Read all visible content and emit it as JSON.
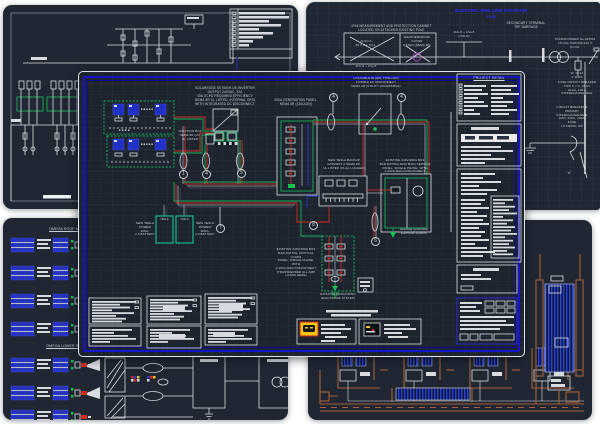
{
  "colors": {
    "sheet_bg": "#202733",
    "line": "#d9dde2",
    "blue_border": "#1414cd",
    "green": "#14b35a",
    "red": "#d22c20",
    "module_blue": "#2231c5",
    "brown": "#a85f38",
    "yellow": "#f3c512",
    "magenta": "#b545c8",
    "title_blue": "#2a2aff",
    "teal": "#12b98e"
  },
  "sheet_top_right": {
    "title": "ELECTRIC ONE LINE DIAGRAM",
    "scale": "1:100",
    "cabinet_note": "IP44 MEASUREMENT AND PROTECTION CABINET\nLOCATED ON ATTACHED EXISTING POLE",
    "cabinet_sub": "ALSO A\n50 T, 6A, POL.",
    "weatherproof_note": "WEATHERPROOF COVER\nRATED (NEMA 3R)",
    "feeder_label": "2No.8 + 1No.8",
    "feeder_label2": "2No.8 + 1No.8\n(ITALO)",
    "secondary_terminal": "SECONDARY TERMINAL\nTRF BARRAGE",
    "transformer_note": "TRANSFORMER No.325501\n15 kVA-7600/240-120 V\nIN OIL",
    "fuse_note": "W, 10 kA\nV IRON",
    "fuse_breaker_note": "FUSE CIRCUIT BREAKER\nTIPO K 7 A, 15 KV\n20 kA, 100 A\nINTERCHANGEABLE",
    "breakers_note": "CIRCUIT BREAKERS\nPRIMARY\nINTERCHANGEABLE\n100V, 20KA, 100A,\nFUSE\nLO DETAIL OR",
    "detail_mark": "\"A\""
  },
  "sheet_main": {
    "inverter_note": "SOLAREDGE SE7600H-US INVERTER\nOUTPUT 240VAC, 32A\n40A OCPD REQUIRED EFFICIENCY\nNEMA 3R UL LISTED, INTERNAL GFDI\nWITH INTEGRATED DC DISCONNECT",
    "junction_note": "JUNCTION BOX\nNEMA 3R (LV)\nUL LISTED",
    "gen_panel_note": "200A GENERATION PANEL,\nNEMA 3R (120/240V)",
    "disconnect_note": "LOCKABLE BLADE TYPE NON\nFUSIBLE AC DISCONNECT\nNEMA 3R (UTILITY ACCESSIBLE)",
    "gateway_note": "NEW TESLA BACKUP\nGATEWAY 2 NEMA 3R,\nUL LISTED (DUAL LUGGED)",
    "service_panel_note": "EXISTING 240V/200A BUS\nBAR RATING 200A MAIN SERVICE\nPANEL, SINGLE PHASE, WITH\nA 200A MAIN DISCONNECT",
    "grounding_note": "(Existing Grounding\nElectrode System)",
    "critical_loads_note": "EXISTING 240V/100A BUS\nBAR RATING, CRITICAL LOADS\nPANEL, SINGLE PHASE, WITH\nA 100A MAIN DISCONNECT\n(TRANSFERRED ALL AMP\nLOADS HERE)",
    "grounding_existing": "EXISTING GROUNDING\nELECTRODE SYSTEM",
    "powerwall_left_note": "NEW TESLA\nPOWER WALL\n2.0 BATTERY",
    "powerwall_right_note": "NEW TESLA\nPOWER WALL\n2.0 BATTERY",
    "powerwall_brand": "TESLA",
    "project_detail_header": "PROJECT DETAIL",
    "conduit_tags": [
      "1",
      "4",
      "5",
      "4",
      "4",
      "7",
      "8",
      "6"
    ]
  },
  "sheet_bottom_left": {
    "header_a": "OMEGA ROOF MODULE (A)",
    "header_b": "OMEGA LOWER ROOF (B)"
  }
}
